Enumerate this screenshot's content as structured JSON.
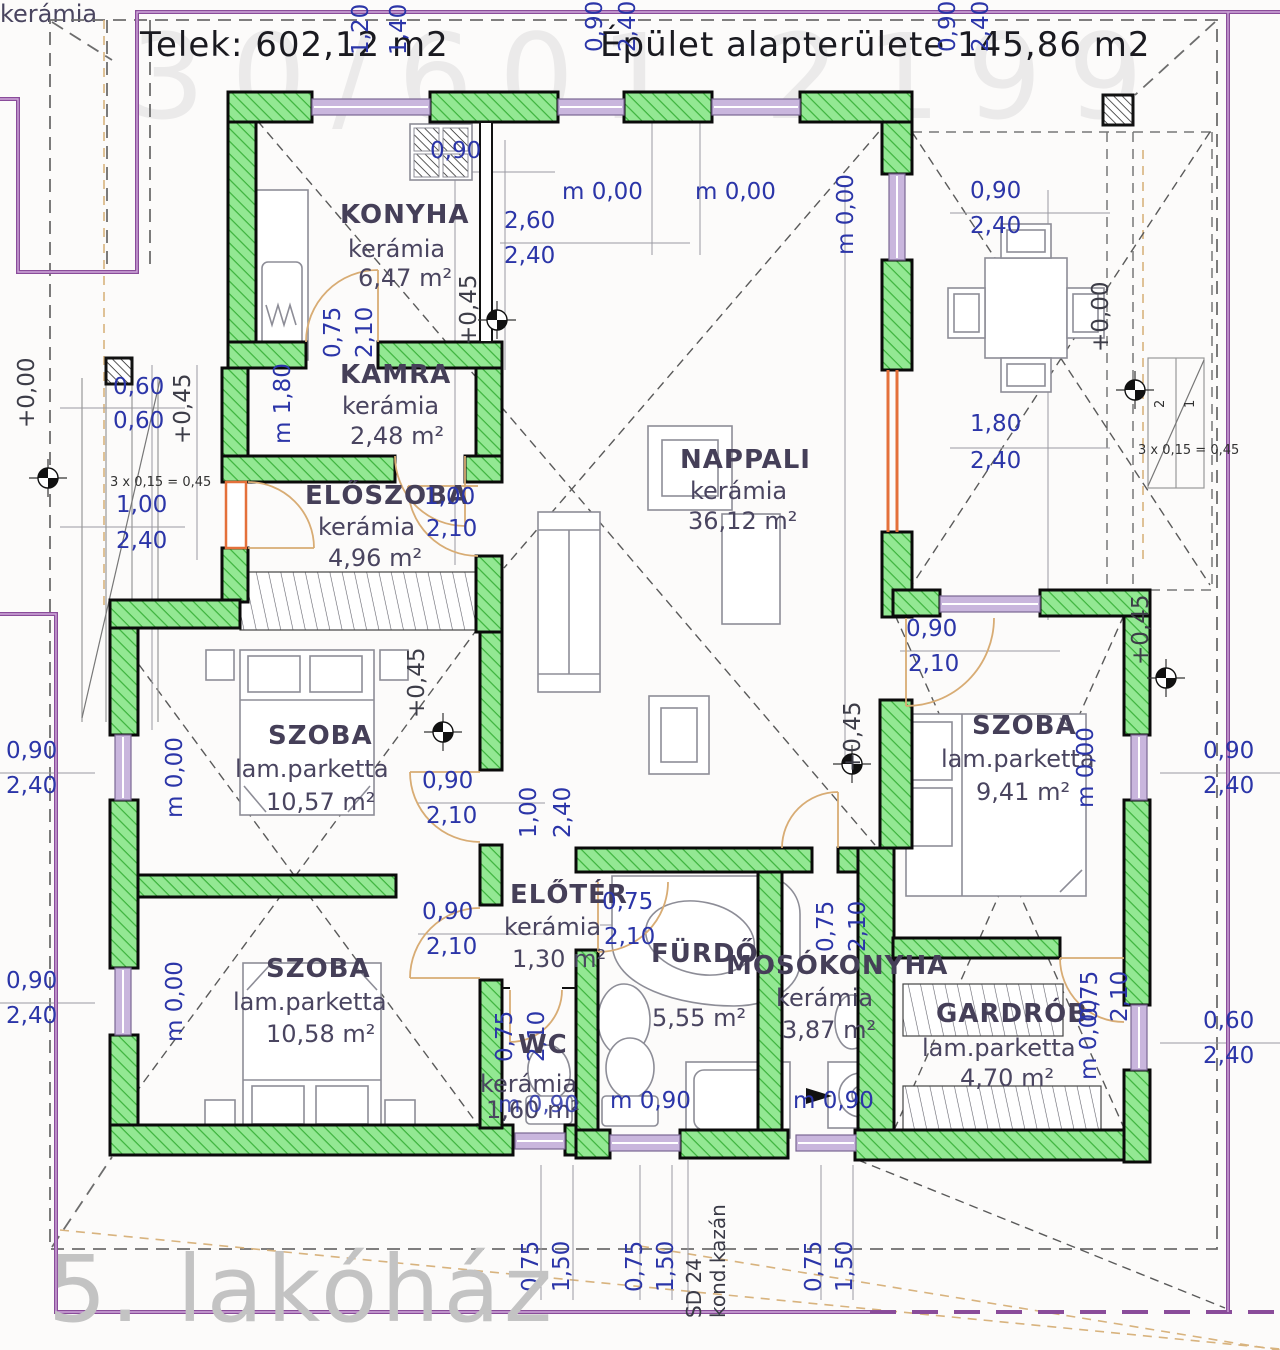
{
  "header": {
    "plot_area": "Telek: 602,12 m2",
    "building_area": "Épület alapterülete 145,86 m2"
  },
  "watermark": {
    "phone": "30/601 2199",
    "project": "5. lakóház"
  },
  "rooms": {
    "konyha": {
      "name": "KONYHA",
      "floor": "kerámia",
      "area": "6,47 m²"
    },
    "kamra": {
      "name": "KAMRA",
      "floor": "kerámia",
      "area": "2,48 m²"
    },
    "eloszoba": {
      "name": "ELŐSZOBA",
      "floor": "kerámia",
      "area": "4,96 m²"
    },
    "nappali": {
      "name": "NAPPALI",
      "floor": "kerámia",
      "area": "36,12 m²"
    },
    "szoba1": {
      "name": "SZOBA",
      "floor": "lam.parketta",
      "area": "10,57 m²"
    },
    "szoba2": {
      "name": "SZOBA",
      "floor": "lam.parketta",
      "area": "10,58 m²"
    },
    "szoba3": {
      "name": "SZOBA",
      "floor": "lam.parketta",
      "area": "9,41 m²"
    },
    "eloter": {
      "name": "ELŐTÉR",
      "floor": "kerámia",
      "area": "1,30 m²"
    },
    "furdo": {
      "name": "FÜRDŐ",
      "floor": "kerámia",
      "area": "5,55 m²"
    },
    "mosokonyha": {
      "name": "MOSÓKONYHA",
      "floor": "kerámia",
      "area": "3,87 m²"
    },
    "wc": {
      "name": "WC",
      "floor": "kerámia",
      "area": "1,60 m²"
    },
    "gardrob": {
      "name": "GARDRÓB",
      "floor": "lam.parketta",
      "area": "4,70 m²"
    }
  },
  "dims": {
    "v060": "0,60",
    "v075": "0,75",
    "v090": "0,90",
    "v100": "1,00",
    "v120": "1,20",
    "v140": "1,40",
    "v150": "1,50",
    "v180": "1,80",
    "v210": "2,10",
    "v240": "2,40",
    "v260": "2,60",
    "lvl000": "+0,00",
    "lvl045": "+0,45",
    "m000": "m 0,00",
    "m090": "m 0,90",
    "m180": "m 1,80",
    "steps": "3 x 0,15 = 0,45",
    "step1": "1",
    "step2": "2",
    "boiler1": "SD 24",
    "boiler2": "kond.kazán"
  }
}
